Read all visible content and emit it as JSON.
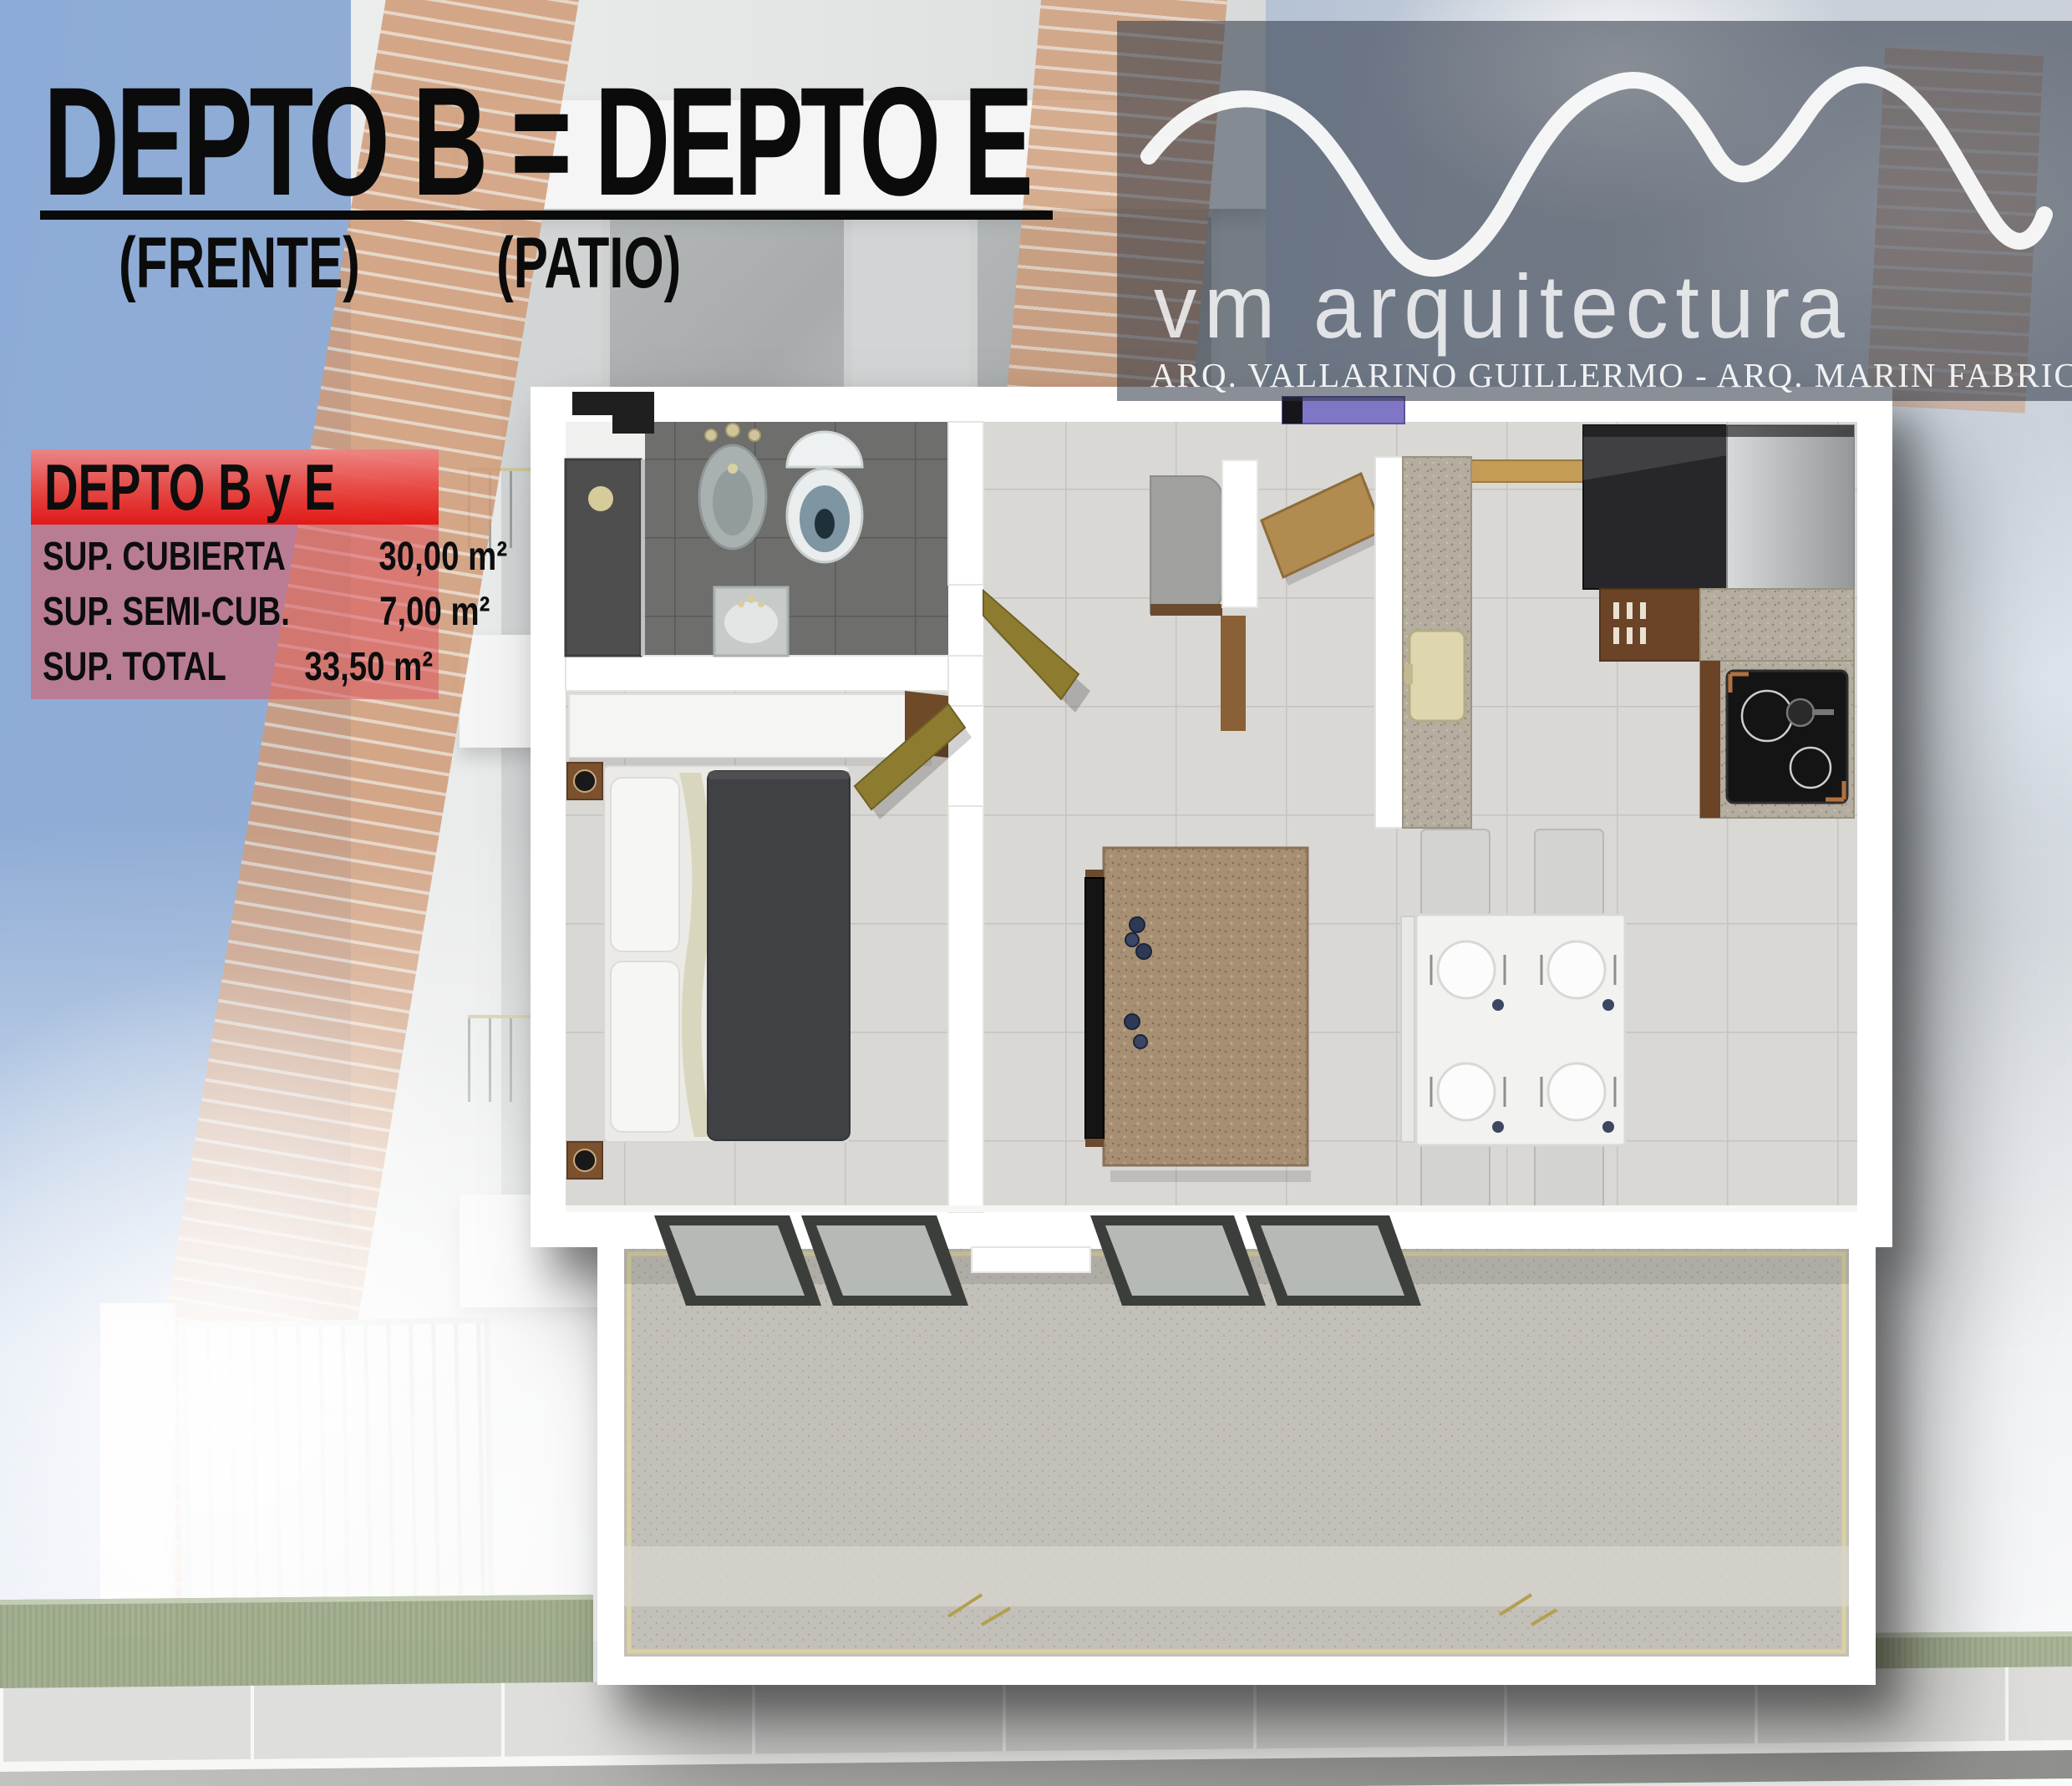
{
  "title": {
    "text": "DEPTO B = DEPTO E",
    "sub_left": "(FRENTE)",
    "sub_right": "(PATIO)"
  },
  "logo": {
    "brand": "vm arquitectura",
    "tagline": "ARQ. VALLARINO GUILLERMO - ARQ. MARIN FABRICIO"
  },
  "info_box": {
    "header": "DEPTO B y E",
    "rows": [
      {
        "label": "SUP. CUBIERTA",
        "value": "30,00 m²"
      },
      {
        "label": "SUP. SEMI-CUB.",
        "value": "7,00 m²"
      },
      {
        "label": "SUP. TOTAL",
        "value": "33,50 m²"
      }
    ]
  },
  "colors": {
    "accent_red": "#e21412",
    "sky_blue": "#8cabd6",
    "logo_band": "#2a3342",
    "brick": "#cf9a76",
    "door_gold": "#8d7c2f",
    "door_wood": "#b18b50",
    "entry_mat_purple": "#7f76c6",
    "duvet_gray": "#404144",
    "grass_green": "#96a47e"
  }
}
